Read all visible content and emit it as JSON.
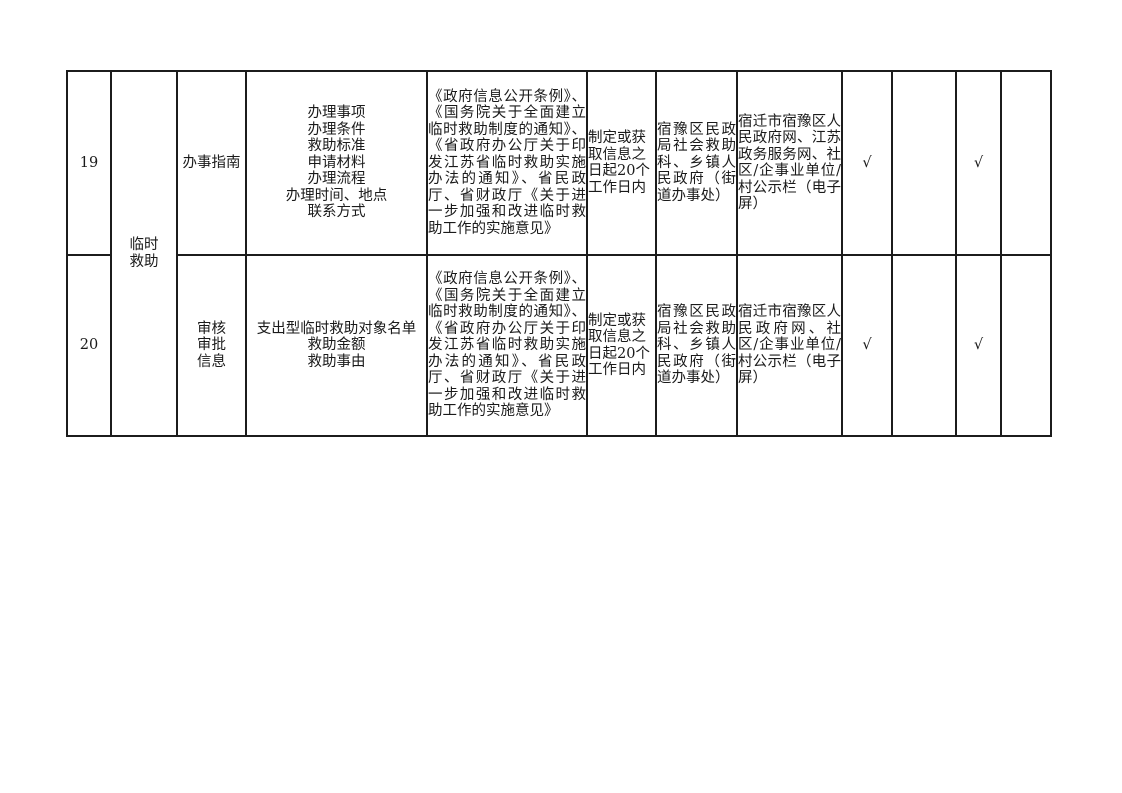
{
  "document": {
    "background": "#ffffff",
    "text_color": "#1a1a1a",
    "border_color": "#1c1c1c",
    "check_glyph": "√"
  },
  "table": {
    "category": "临时\n救助",
    "rows": [
      {
        "seq": "19",
        "item": "办事指南",
        "content": "办理事项\n办理条件\n救助标准\n申请材料\n办理流程\n办理时间、地点\n联系方式",
        "basis": "《政府信息公开条例》、《国务院关于全面建立临时救助制度的通知》、《省政府办公厅关于印发江苏省临时救助实施办法的通知》、省民政厅、省财政厅《关于进一步加强和改进临时救助工作的实施意见》",
        "time_limit": "制定或获取信息之日起20个工作日内",
        "subject": "宿豫区民政局社会救助科、乡镇人民政府（街道办事处）",
        "channel": "宿迁市宿豫区人民政府网、江苏政务服务网、社区/企事业单位/村公示栏（电子屏）",
        "checks": [
          "√",
          "",
          "√",
          ""
        ]
      },
      {
        "seq": "20",
        "item": "审核\n审批\n信息",
        "content": "支出型临时救助对象名单\n救助金额\n救助事由",
        "basis": "《政府信息公开条例》、《国务院关于全面建立临时救助制度的通知》、《省政府办公厅关于印发江苏省临时救助实施办法的通知》、省民政厅、省财政厅《关于进一步加强和改进临时救助工作的实施意见》",
        "time_limit": "制定或获取信息之日起20个工作日内",
        "subject": "宿豫区民政局社会救助科、乡镇人民政府（街道办事处）",
        "channel": "宿迁市宿豫区人民政府网、社区/企事业单位/村公示栏（电子屏）",
        "checks": [
          "√",
          "",
          "√",
          ""
        ]
      }
    ]
  }
}
